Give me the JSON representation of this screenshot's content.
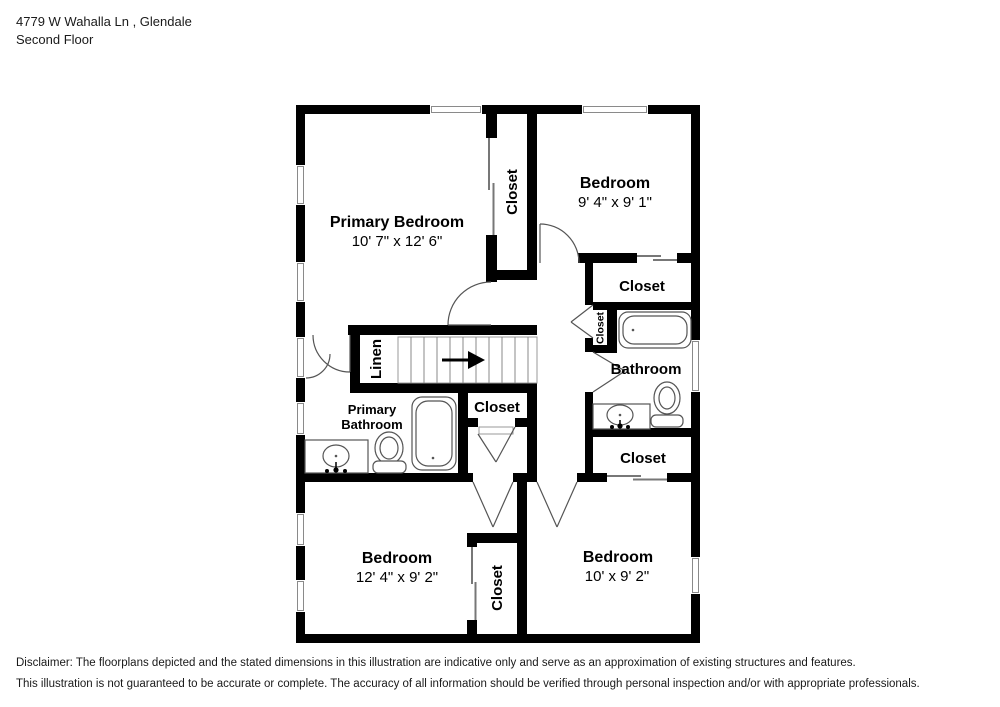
{
  "header": {
    "address": "4779 W Wahalla Ln , Glendale",
    "floor": "Second Floor"
  },
  "labels": {
    "primary_bedroom": {
      "name": "Primary Bedroom",
      "dims": "10' 7\" x 12' 6\""
    },
    "bedroom_top_right": {
      "name": "Bedroom",
      "dims": "9' 4\" x 9' 1\""
    },
    "bedroom_bottom_left": {
      "name": "Bedroom",
      "dims": "12' 4\" x 9' 2\""
    },
    "bedroom_bottom_right": {
      "name": "Bedroom",
      "dims": "10' x 9' 2\""
    },
    "closet_primary_hall": "Closet",
    "closet_bedroom_top_right": "Closet",
    "closet_hall_small": "Closet",
    "closet_hall": "Closet",
    "closet_bathroom_lower": "Closet",
    "closet_bottom_middle": "Closet",
    "bathroom": "Bathroom",
    "primary_bathroom": {
      "line1": "Primary",
      "line2": "Bathroom"
    },
    "linen": "Linen"
  },
  "disclaimer": {
    "line1": "Disclaimer: The floorplans depicted and the stated dimensions in this illustration are indicative only and serve as an approximation of existing structures and features.",
    "line2": "This illustration is not guaranteed to be accurate or complete. The accuracy of all information should be verified through personal inspection and/or with appropriate professionals."
  },
  "colors": {
    "wall": "#000000",
    "window_line": "#8a8a8a",
    "fixture_line": "#555555"
  }
}
